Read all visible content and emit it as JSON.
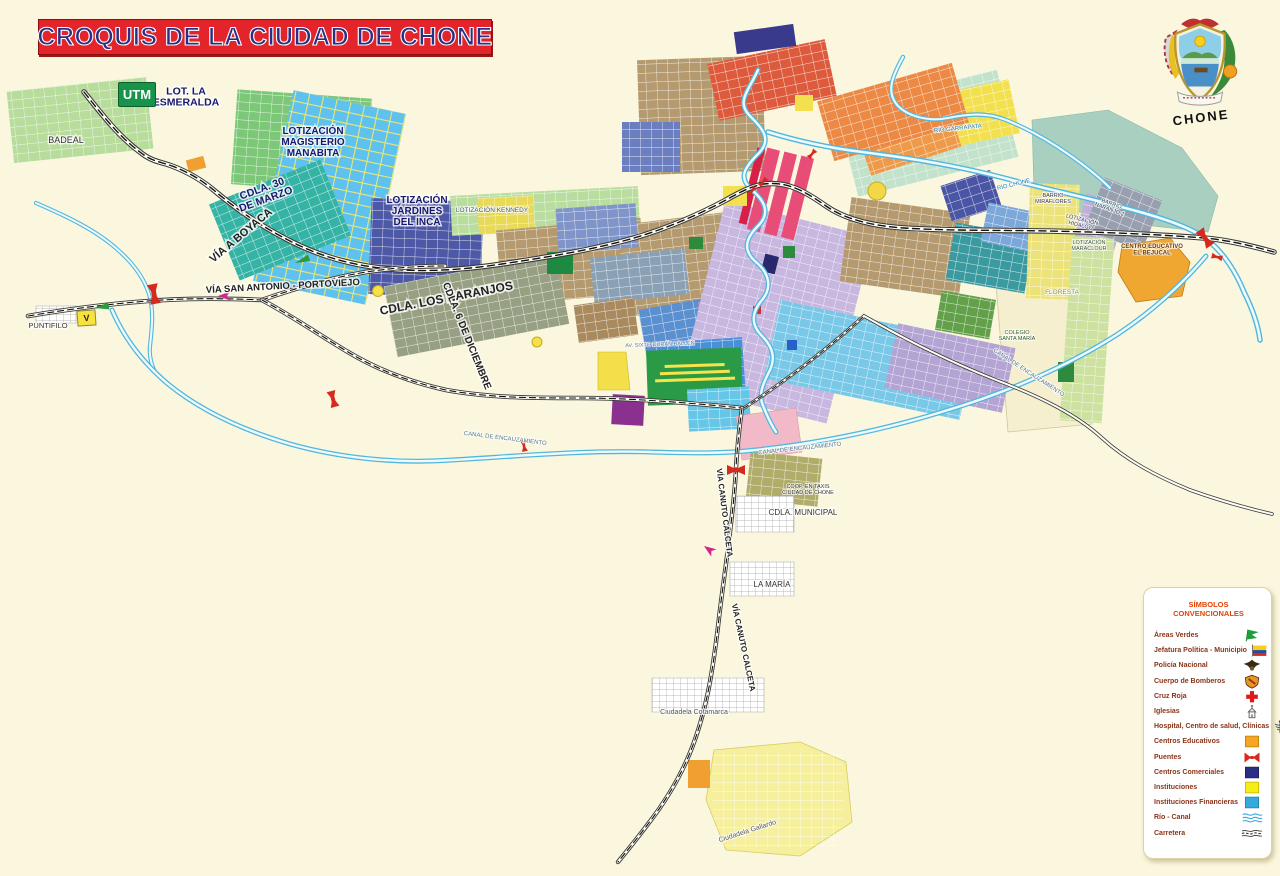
{
  "title": "CROQUIS DE LA CIUDAD DE CHONE",
  "emblem_caption": "CHONE",
  "badges": {
    "utm": "UTM",
    "v_marker": "V"
  },
  "colors": {
    "background": "#FAF7DE",
    "title_bg": "#E3242B",
    "title_text": "#2B2E83",
    "legend_title": "#E84000",
    "legend_text": "#8A3418",
    "water": "#53B7DC",
    "road": "#3A3A3A",
    "bridge": "#D42A20",
    "education": "#F5A623",
    "commercial": "#2B2E83",
    "institution": "#F7EC13",
    "financial": "#35A8DC",
    "green_area": "#1F9D3A"
  },
  "legend": {
    "title": "SÍMBOLOS CONVENCIONALES",
    "items": [
      {
        "label": "Áreas Verdes",
        "icon": "green-flag"
      },
      {
        "label": "Jefatura Política - Municipio",
        "icon": "ecuador-flag"
      },
      {
        "label": "Policía Nacional",
        "icon": "police-eagle"
      },
      {
        "label": "Cuerpo de Bomberos",
        "icon": "fire-crest"
      },
      {
        "label": "Cruz Roja",
        "icon": "red-cross"
      },
      {
        "label": "Iglesias",
        "icon": "church"
      },
      {
        "label": "Hospital, Centro de salud, Clínicas",
        "icon": "caduceus"
      },
      {
        "label": "Centros Educativos",
        "icon": "orange-square"
      },
      {
        "label": "Puentes",
        "icon": "bridge"
      },
      {
        "label": "Centros Comerciales",
        "icon": "navy-square"
      },
      {
        "label": "Instituciones",
        "icon": "yellow-square"
      },
      {
        "label": "Instituciones Financieras",
        "icon": "blue-square"
      },
      {
        "label": "Río - Canal",
        "icon": "waves"
      },
      {
        "label": "Carretera",
        "icon": "dashed-road"
      }
    ]
  },
  "map": {
    "labels": [
      {
        "t": "BADEAL",
        "x": 66,
        "y": 143,
        "s": 9,
        "c": "#333333"
      },
      {
        "t": "LOT. LA\nESMERALDA",
        "x": 186,
        "y": 100,
        "s": 10.5,
        "c": "#18186e",
        "b": 1
      },
      {
        "t": "LOTIZACIÓN\nMAGISTERIO\nMANABITA",
        "x": 313,
        "y": 145,
        "s": 10,
        "c": "#18186e",
        "b": 1
      },
      {
        "t": "CDLA. 30\nDE MARZO",
        "x": 265,
        "y": 197,
        "s": 10.5,
        "c": "#18186e",
        "b": 1,
        "r": -20
      },
      {
        "t": "VÍA  A  BOYACA",
        "x": 243,
        "y": 238,
        "s": 11,
        "c": "#222222",
        "b": 1,
        "r": -40
      },
      {
        "t": "LOTIZACIÓN\nJARDINES\nDEL INCA",
        "x": 417,
        "y": 214,
        "s": 10,
        "c": "#18186e",
        "b": 1
      },
      {
        "t": "LOTIZACIÓN KENNEDY",
        "x": 492,
        "y": 212,
        "s": 6.5,
        "c": "#445577"
      },
      {
        "t": "VÍA SAN ANTONIO - PORTOVIEJO",
        "x": 283,
        "y": 289,
        "s": 9.5,
        "c": "#222222",
        "b": 1,
        "r": -3
      },
      {
        "t": "CDLA.  LOS NARANJOS",
        "x": 447,
        "y": 302,
        "s": 12,
        "c": "#222222",
        "b": 1,
        "r": -11
      },
      {
        "t": "CDLA. 6 DE DICIEMBRE",
        "x": 464,
        "y": 337,
        "s": 10,
        "c": "#222222",
        "b": 1,
        "r": 68
      },
      {
        "t": "PUNTIFILO",
        "x": 48,
        "y": 328,
        "s": 7.5,
        "c": "#333333"
      },
      {
        "t": "RÍO GARRAPATA",
        "x": 958,
        "y": 130,
        "s": 6,
        "c": "#1f7ab0",
        "r": -6
      },
      {
        "t": "RÍO CHONE",
        "x": 1014,
        "y": 186,
        "s": 6,
        "c": "#1f7ab0",
        "r": -14
      },
      {
        "t": "BARRIO\nMIRAFLORES",
        "x": 1053,
        "y": 200,
        "s": 5.5,
        "c": "#333366"
      },
      {
        "t": "LOTIZACIÓN\nHIDALGO",
        "x": 1081,
        "y": 224,
        "s": 5.5,
        "c": "#333366",
        "r": 14
      },
      {
        "t": "BARRIO\nNARANJO 2",
        "x": 1110,
        "y": 208,
        "s": 5.5,
        "c": "#334455",
        "r": 20
      },
      {
        "t": "CENTRO EDUCATIVO\nEL BEJUCAL",
        "x": 1152,
        "y": 251,
        "s": 6,
        "c": "#6e3a00",
        "b": 1
      },
      {
        "t": "LOTIZACIÓN\nMARACLOUR",
        "x": 1089,
        "y": 247,
        "s": 5.5,
        "c": "#445544"
      },
      {
        "t": "FLORESTA",
        "x": 1062,
        "y": 294,
        "s": 6.5,
        "c": "#8a8a66"
      },
      {
        "t": "COLEGIO\nSANTA MARÍA",
        "x": 1017,
        "y": 337,
        "s": 5.5,
        "c": "#2a5a2a"
      },
      {
        "t": "CANAL DE ENCAUZAMIENTO",
        "x": 505,
        "y": 440,
        "s": 6,
        "c": "#557788",
        "r": 7
      },
      {
        "t": "CANAL DE ENCAUZAMIENTO",
        "x": 800,
        "y": 450,
        "s": 6,
        "c": "#557788",
        "r": -6
      },
      {
        "t": "CANAL DE ENCAUZAMIENTO",
        "x": 1028,
        "y": 374,
        "s": 6,
        "c": "#557788",
        "r": 33
      },
      {
        "t": "VÍA CANUTO CALCETA",
        "x": 722,
        "y": 513,
        "s": 8,
        "c": "#222222",
        "b": 1,
        "r": 83
      },
      {
        "t": "VÍA CANUTO CALCETA",
        "x": 741,
        "y": 648,
        "s": 8,
        "c": "#222222",
        "b": 1,
        "r": 78
      },
      {
        "t": "COOP. EN TAXIS\nCIUDAD DE CHONE",
        "x": 808,
        "y": 491,
        "s": 5.5,
        "c": "#333333"
      },
      {
        "t": "CDLA. MUNICIPAL",
        "x": 803,
        "y": 515,
        "s": 8,
        "c": "#333333"
      },
      {
        "t": "LA MARÍA",
        "x": 772,
        "y": 587,
        "s": 8,
        "c": "#333333"
      },
      {
        "t": "Ciudadela Cotamarca",
        "x": 694,
        "y": 714,
        "s": 7,
        "c": "#555555"
      },
      {
        "t": "Ciudadela Gallardo",
        "x": 748,
        "y": 833,
        "s": 7,
        "c": "#555555",
        "r": -18
      },
      {
        "t": "AV. SIXTO DURÁN BALLÉN",
        "x": 660,
        "y": 346,
        "s": 5.5,
        "c": "#667788",
        "r": -2
      }
    ]
  }
}
